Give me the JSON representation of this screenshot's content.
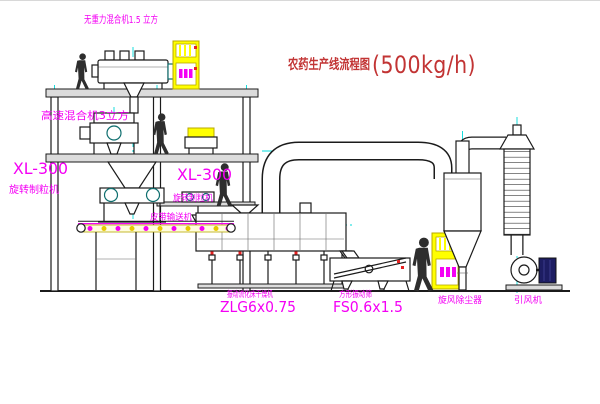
{
  "title": {
    "text": "农药生产线流程图",
    "capacity": "(500kg/h)"
  },
  "equipment_labels": {
    "gravity_mixer": "无重力混合机1.5 立方",
    "high_speed_mixer": "高速混合机3立方",
    "granulator_left_model": "XL-300",
    "granulator_left_name": "旋转制粒机",
    "granulator_right_model": "XL-300",
    "granulator_right_name": "旋转制粒机",
    "belt_conveyor": "皮带输送机",
    "fluid_bed_dryer_name": "振动流化床干燥机",
    "fluid_bed_dryer_model": "ZLG6x0.75",
    "vibrating_sieve_name": "方形振动筛",
    "vibrating_sieve_model": "FS0.6x1.5",
    "cyclone_dust_collector": "旋风除尘器",
    "induced_draft_fan": "引风机"
  },
  "colors": {
    "line": "#1b1b1b",
    "centerline": "#00d9d9",
    "label_magenta": "#f400f4",
    "title_red": "#c23434",
    "cabinet_yellow": "#ffff00",
    "accent_red": "#e52222",
    "machine_teal": "#0e6e6e"
  }
}
